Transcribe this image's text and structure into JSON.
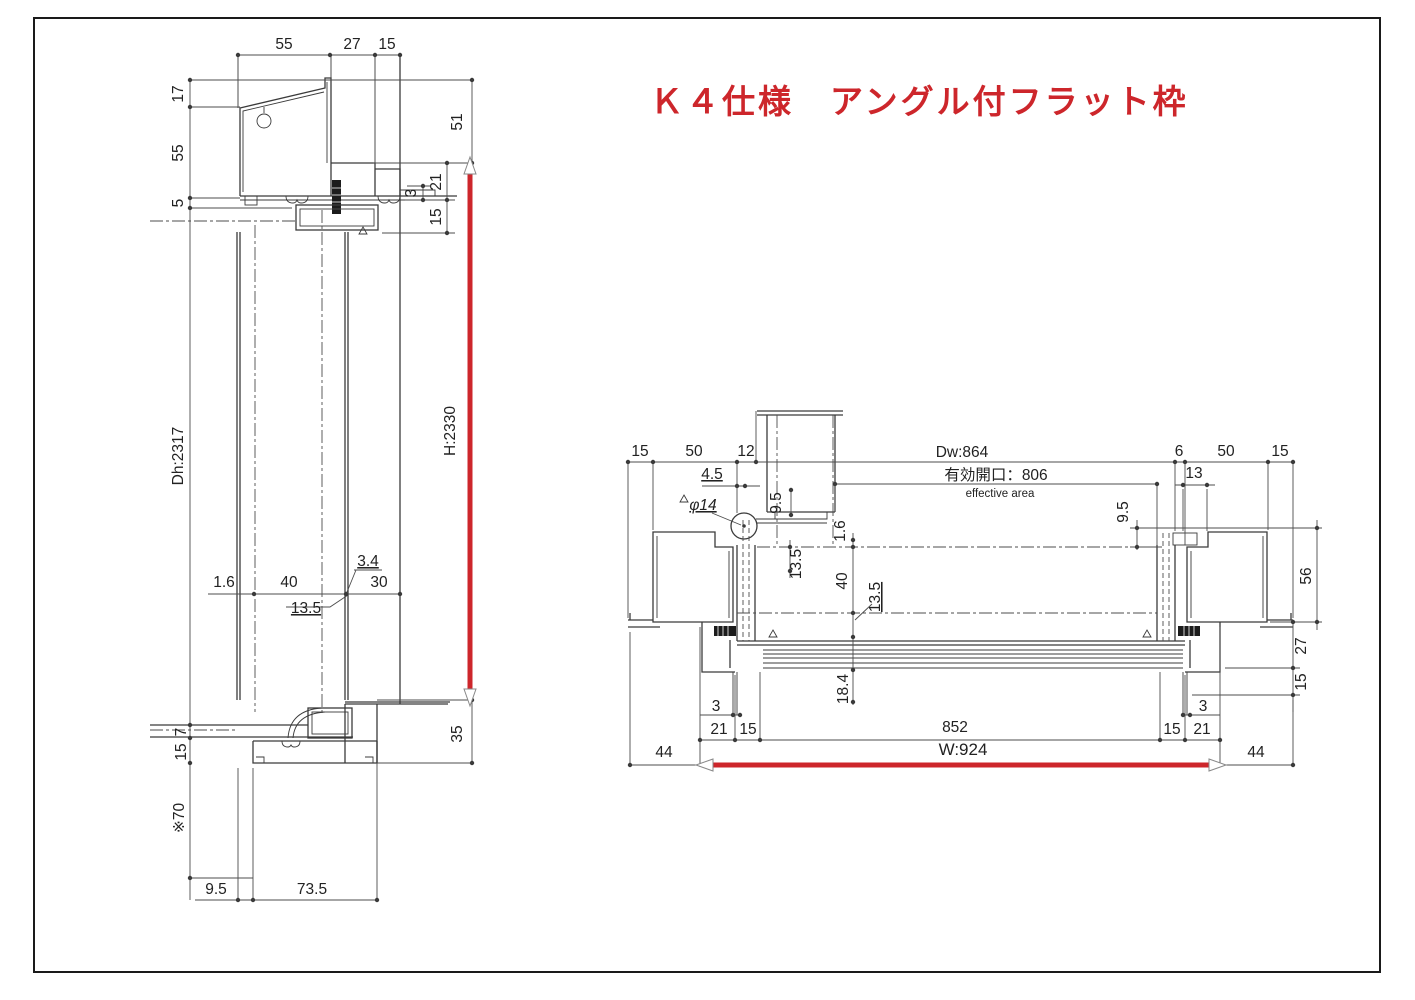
{
  "title": {
    "text": "Ｋ４仕様　アングル付フラット枠",
    "color": "#cd262b"
  },
  "colors": {
    "red": "#cd262b",
    "line": "#3b3b3b"
  },
  "left_section": {
    "labels": [
      {
        "t": "55",
        "x": 284,
        "y": 49
      },
      {
        "t": "27",
        "x": 352,
        "y": 49
      },
      {
        "t": "15",
        "x": 387,
        "y": 49
      },
      {
        "t": "17",
        "x": 183,
        "y": 94,
        "r": -90
      },
      {
        "t": "55",
        "x": 183,
        "y": 153,
        "r": -90
      },
      {
        "t": "5",
        "x": 183,
        "y": 203,
        "r": -90
      },
      {
        "t": "51",
        "x": 462,
        "y": 122,
        "r": -90
      },
      {
        "t": "3",
        "x": 416,
        "y": 193,
        "r": -90
      },
      {
        "t": "21",
        "x": 441,
        "y": 182,
        "r": -90
      },
      {
        "t": "15",
        "x": 441,
        "y": 217,
        "r": -90
      },
      {
        "t": "Dh:2317",
        "x": 183,
        "y": 456,
        "r": -90
      },
      {
        "t": "H:2330",
        "x": 455,
        "y": 431,
        "r": -90
      },
      {
        "t": "1.6",
        "x": 224,
        "y": 587
      },
      {
        "t": "40",
        "x": 289,
        "y": 587
      },
      {
        "t": "3.4",
        "x": 368,
        "y": 566,
        "ul": 1
      },
      {
        "t": "30",
        "x": 379,
        "y": 587
      },
      {
        "t": "13.5",
        "x": 306,
        "y": 613,
        "ul": 1
      },
      {
        "t": "7",
        "x": 186,
        "y": 732,
        "r": -90
      },
      {
        "t": "15",
        "x": 186,
        "y": 752,
        "r": -90
      },
      {
        "t": "35",
        "x": 462,
        "y": 734,
        "r": -90
      },
      {
        "t": "※70",
        "x": 184,
        "y": 818,
        "r": -90
      },
      {
        "t": "9.5",
        "x": 216,
        "y": 894
      },
      {
        "t": "73.5",
        "x": 312,
        "y": 894
      }
    ]
  },
  "right_section": {
    "labels": [
      {
        "t": "15",
        "x": 640,
        "y": 456
      },
      {
        "t": "50",
        "x": 694,
        "y": 456
      },
      {
        "t": "12",
        "x": 746,
        "y": 456
      },
      {
        "t": "Dw:864",
        "x": 962,
        "y": 457
      },
      {
        "t": "有効開口：806",
        "x": 996,
        "y": 480
      },
      {
        "t": "effective area",
        "x": 1000,
        "y": 497,
        "s": 11.5
      },
      {
        "t": "6",
        "x": 1179,
        "y": 456
      },
      {
        "t": "50",
        "x": 1226,
        "y": 456
      },
      {
        "t": "15",
        "x": 1280,
        "y": 456
      },
      {
        "t": "4.5",
        "x": 712,
        "y": 479,
        "ul": 1
      },
      {
        "t": "13",
        "x": 1194,
        "y": 478
      },
      {
        "t": "φ14",
        "x": 703,
        "y": 510,
        "ul": 1,
        "i": 1
      },
      {
        "t": "9.5",
        "x": 781,
        "y": 503,
        "r": -90
      },
      {
        "t": "9.5",
        "x": 1128,
        "y": 512,
        "r": -90
      },
      {
        "t": "1.6",
        "x": 845,
        "y": 531,
        "r": -90
      },
      {
        "t": "13.5",
        "x": 801,
        "y": 564,
        "r": -90
      },
      {
        "t": "40",
        "x": 847,
        "y": 581,
        "r": -90
      },
      {
        "t": "13.5",
        "x": 880,
        "y": 597,
        "r": -90,
        "ul": 1
      },
      {
        "t": "56",
        "x": 1311,
        "y": 576,
        "r": -90
      },
      {
        "t": "18.4",
        "x": 848,
        "y": 689,
        "r": -90
      },
      {
        "t": "27",
        "x": 1306,
        "y": 646,
        "r": -90
      },
      {
        "t": "15",
        "x": 1306,
        "y": 682,
        "r": -90
      },
      {
        "t": "3",
        "x": 716,
        "y": 711
      },
      {
        "t": "3",
        "x": 1203,
        "y": 711
      },
      {
        "t": "21",
        "x": 719,
        "y": 734
      },
      {
        "t": "15",
        "x": 748,
        "y": 734
      },
      {
        "t": "852",
        "x": 955,
        "y": 732
      },
      {
        "t": "15",
        "x": 1172,
        "y": 734
      },
      {
        "t": "21",
        "x": 1202,
        "y": 734
      },
      {
        "t": "W:924",
        "x": 963,
        "y": 755,
        "s": 17
      },
      {
        "t": "44",
        "x": 664,
        "y": 757
      },
      {
        "t": "44",
        "x": 1256,
        "y": 757
      }
    ]
  }
}
